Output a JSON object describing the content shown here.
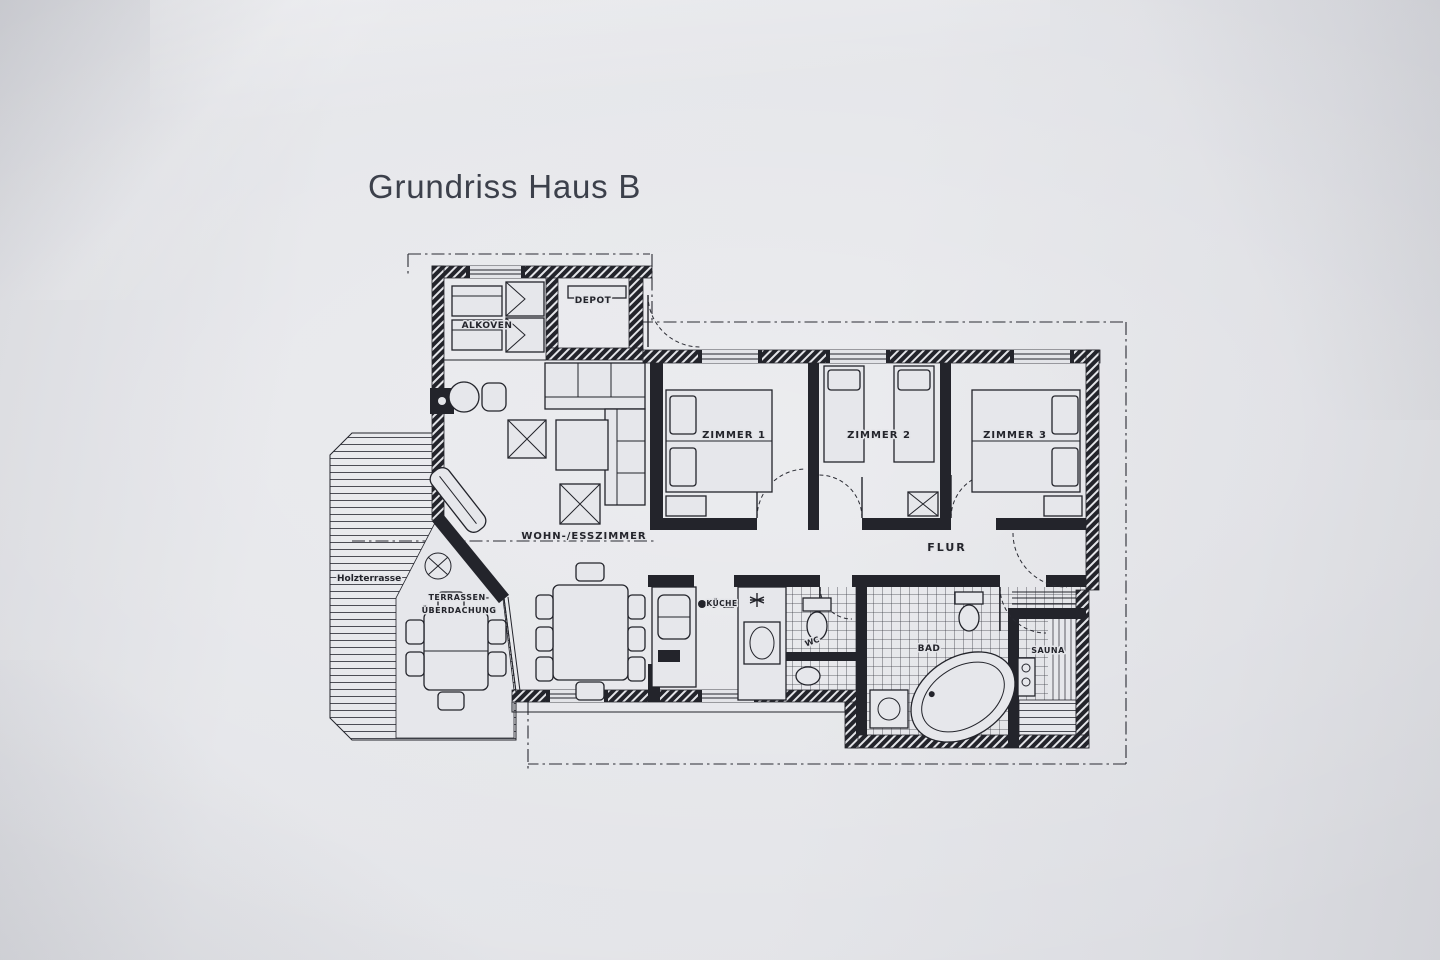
{
  "title": "Grundriss Haus B",
  "colors": {
    "paper": "#e3e4e8",
    "ink": "#23242b",
    "title_text": "#3c404b"
  },
  "plan": {
    "labels": {
      "alkoven": "ALKOVEN",
      "depot": "DEPOT",
      "zimmer1": "ZIMMER 1",
      "zimmer2": "ZIMMER 2",
      "zimmer3": "ZIMMER 3",
      "wohnzimmer": "WOHN-/ESSZIMMER",
      "flur": "FLUR",
      "kueche": "KÜCHE",
      "wc": "WC",
      "bad": "BAD",
      "sauna": "SAUNA",
      "terrasse_line1": "TERRASSEN-",
      "terrasse_line2": "ÜBERDACHUNG",
      "holzterrasse": "Holzterrasse"
    }
  }
}
